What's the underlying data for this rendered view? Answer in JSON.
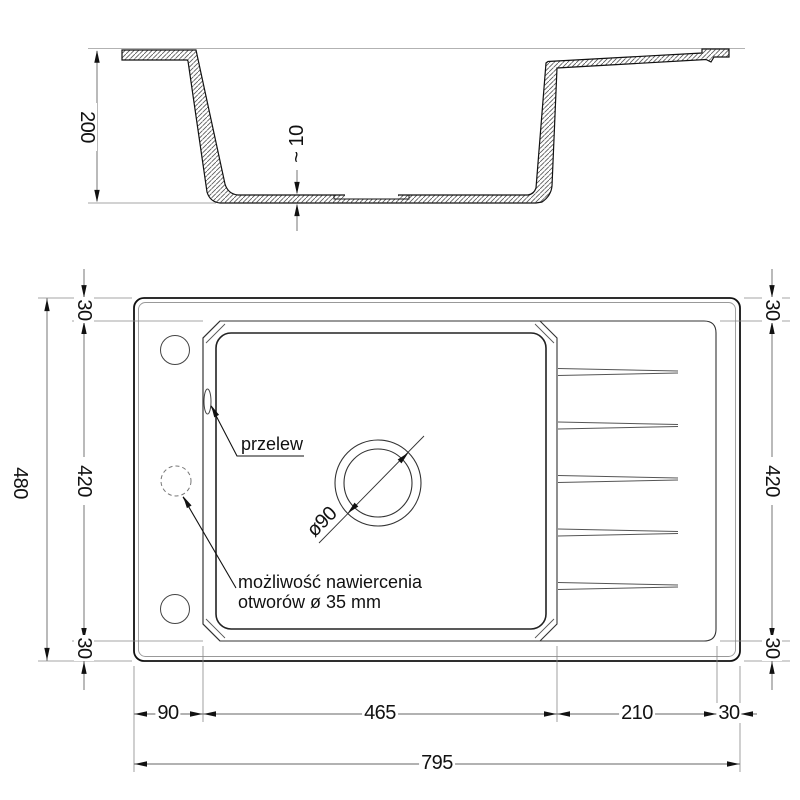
{
  "section": {
    "height": "200",
    "bottom_thickness": "~ 10"
  },
  "plan": {
    "overall_height": "480",
    "left": {
      "top": "30",
      "middle": "420",
      "bottom": "30"
    },
    "right": {
      "top": "30",
      "middle": "420",
      "bottom": "30"
    },
    "bottom": {
      "left_margin": "90",
      "bowl": "465",
      "drainer": "210",
      "right_margin": "30",
      "total": "795"
    },
    "drain_diameter": "ø90",
    "overflow_label": "przelew",
    "note_line1": "możliwość nawiercenia",
    "note_line2": "otworów ø 35 mm"
  },
  "colors": {
    "line": "#111111",
    "thin_line": "#888888",
    "hatch": "#444444"
  }
}
